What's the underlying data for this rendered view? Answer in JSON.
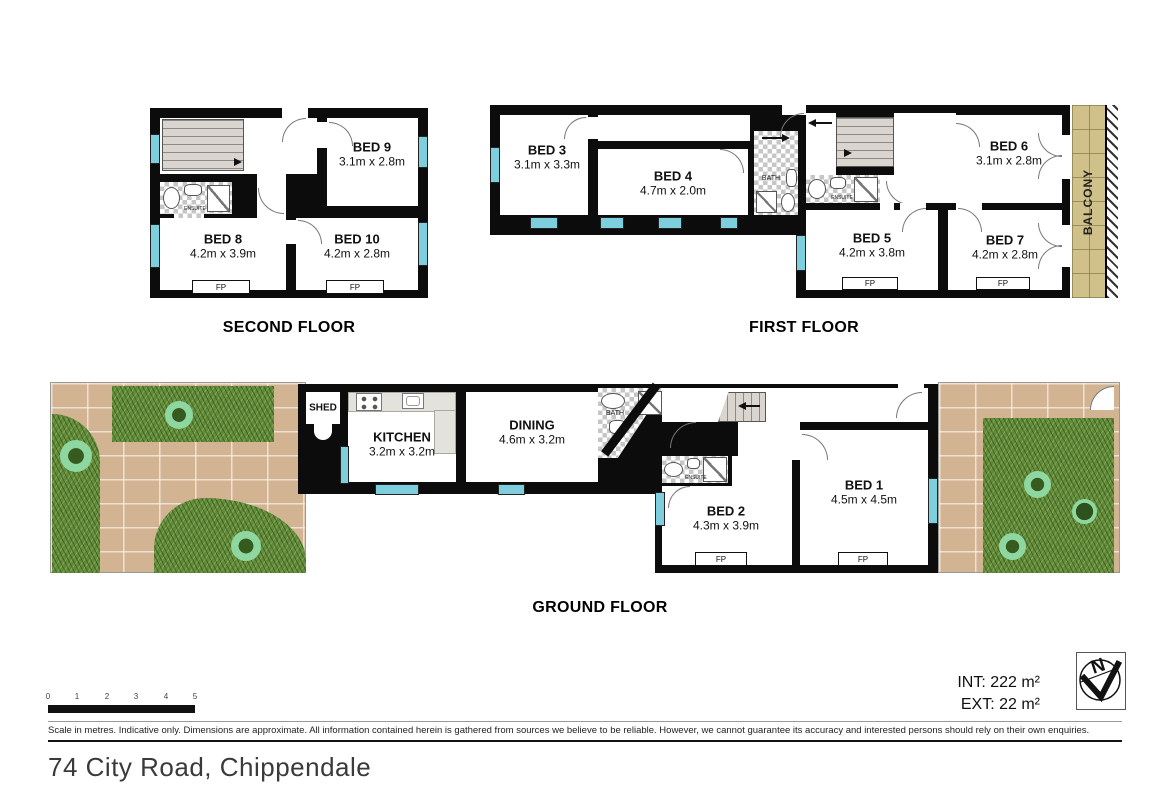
{
  "address": "74 City Road, Chippendale",
  "floors": {
    "second": {
      "title": "SECOND FLOOR",
      "rooms": {
        "bed8": {
          "name": "BED 8",
          "dims": "4.2m x 3.9m"
        },
        "bed9": {
          "name": "BED 9",
          "dims": "3.1m x 2.8m"
        },
        "bed10": {
          "name": "BED 10",
          "dims": "4.2m x 2.8m"
        },
        "ensuite": {
          "name": "ENSUITE"
        }
      }
    },
    "first": {
      "title": "FIRST FLOOR",
      "rooms": {
        "bed3": {
          "name": "BED 3",
          "dims": "3.1m x 3.3m"
        },
        "bed4": {
          "name": "BED 4",
          "dims": "4.7m x 2.0m"
        },
        "bed5": {
          "name": "BED 5",
          "dims": "4.2m x 3.8m"
        },
        "bed6": {
          "name": "BED 6",
          "dims": "3.1m x 2.8m"
        },
        "bed7": {
          "name": "BED 7",
          "dims": "4.2m x 2.8m"
        },
        "bath": {
          "name": "BATH"
        },
        "ensuite": {
          "name": "ENSUITE"
        },
        "balcony": {
          "name": "BALCONY"
        }
      }
    },
    "ground": {
      "title": "GROUND FLOOR",
      "rooms": {
        "shed": {
          "name": "SHED"
        },
        "kitchen": {
          "name": "KITCHEN",
          "dims": "3.2m x 3.2m"
        },
        "dining": {
          "name": "DINING",
          "dims": "4.6m x 3.2m"
        },
        "bath": {
          "name": "BATH"
        },
        "ensuite": {
          "name": "ENSUITE"
        },
        "bed1": {
          "name": "BED 1",
          "dims": "4.5m x 4.5m"
        },
        "bed2": {
          "name": "BED 2",
          "dims": "4.3m x 3.9m"
        }
      }
    }
  },
  "fireplace_label": "FP",
  "scale_bar": {
    "ticks": [
      "0",
      "1",
      "2",
      "3",
      "4",
      "5"
    ]
  },
  "areas": {
    "internal": "INT: 222 m²",
    "external": "EXT: 22 m²"
  },
  "compass": {
    "north_label": "N"
  },
  "disclaimer": "Scale in metres. Indicative only. Dimensions are approximate. All information contained herein is gathered from sources we believe to be reliable. However, we cannot guarantee its accuracy and interested persons should rely on their own enquiries.",
  "colors": {
    "wall": "#0c0c0c",
    "window": "#7ecfdd",
    "stairs": "#dad5ce",
    "balcony_tile": "#cfc189",
    "grass": "#628c3b",
    "paver": "#d2b493",
    "bush": "#8fd7a0"
  }
}
